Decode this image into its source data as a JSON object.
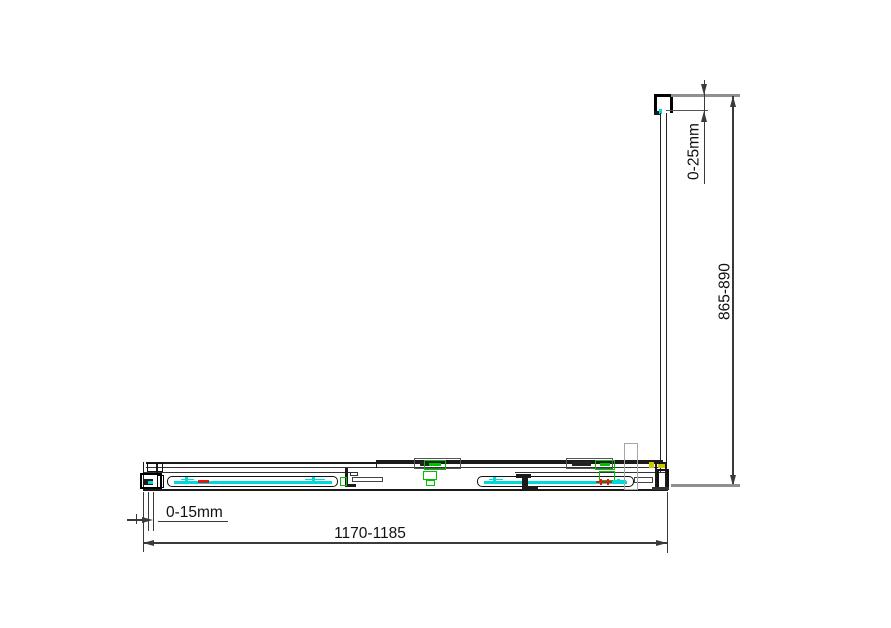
{
  "dimensions": {
    "door_width": "1170-1185",
    "side_depth": "865-890",
    "wall_profile_adjust_left": "0-15mm",
    "wall_profile_adjust_top": "0-25mm"
  },
  "colors": {
    "line": "#1a1a1a",
    "dimension": "#3a3a3a",
    "reference_gray": "#8f8f8f",
    "glass_cyan": "#00d9d9",
    "roller_green": "#00c300",
    "marker_red": "#e81414",
    "marker_yellow": "#c9c900",
    "handle_gray": "#a6a6a6"
  }
}
